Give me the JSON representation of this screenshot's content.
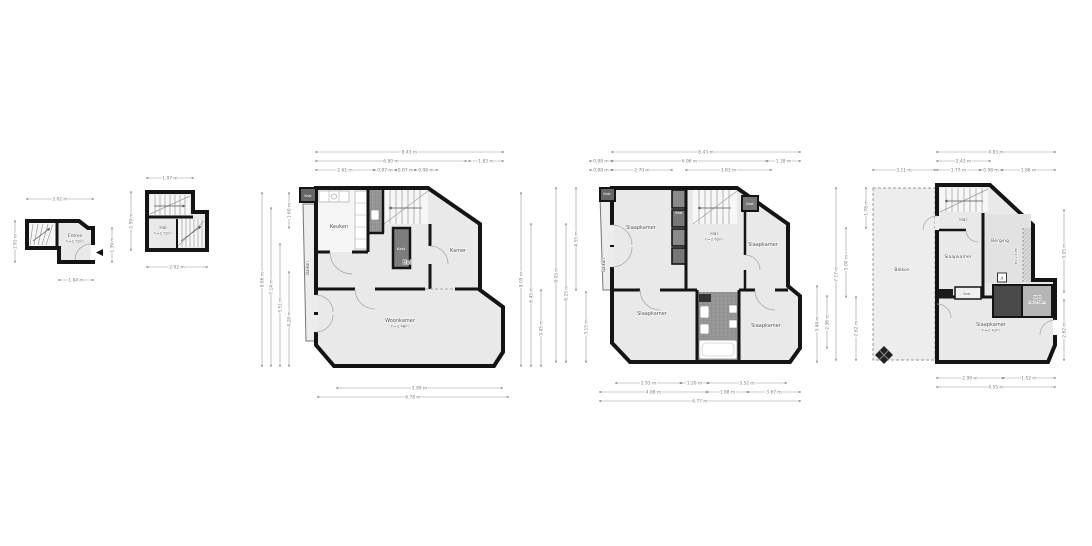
{
  "colors": {
    "wall": "#141414",
    "room": "#e9e9e9",
    "room_light": "#f6f6f6",
    "tiled": "#989898",
    "closet_dark": "#4a4a4a",
    "closet_mid": "#7d7d7d",
    "closet_gray": "#b5b5b5",
    "balcony": "#ededed",
    "dim_line": "#999999",
    "dim_text": "#808080",
    "label_text": "#4a4a4a"
  },
  "plans": [
    {
      "rooms": [
        {
          "label": "Entree",
          "sub": "h=2.52m",
          "x": 75,
          "y": 237,
          "size": 4.4
        }
      ],
      "dims": {
        "horizontal": [
          {
            "label": "3.02 m",
            "x1": 27,
            "x2": 93,
            "y": 199
          },
          {
            "label": "1.84 m",
            "x1": 59,
            "x2": 93,
            "y": 280
          }
        ],
        "vertical": [
          {
            "label": "1.91 m",
            "x": 15,
            "y1": 221,
            "y2": 262
          },
          {
            "label": "1.39 m",
            "x": 112,
            "y1": 228,
            "y2": 262
          }
        ]
      }
    },
    {
      "rooms": [
        {
          "label": "Hal",
          "sub": "h=2.52m",
          "x": 163,
          "y": 229,
          "size": 4.4
        }
      ],
      "dims": {
        "horizontal": [
          {
            "label": "1.97 m",
            "x1": 147,
            "x2": 193,
            "y": 178
          },
          {
            "label": "2.92 m",
            "x1": 147,
            "x2": 207,
            "y": 267
          }
        ],
        "vertical": [
          {
            "label": "2.59 m",
            "x": 131,
            "y1": 192,
            "y2": 250
          }
        ]
      }
    },
    {
      "rooms": [
        {
          "label": "Keuken",
          "x": 339,
          "y": 228
        },
        {
          "label": "Hal",
          "x": 407,
          "y": 264
        },
        {
          "label": "Kamer",
          "x": 458,
          "y": 252
        },
        {
          "label": "Woonkamer",
          "sub": "h=2.48m",
          "x": 400,
          "y": 322
        },
        {
          "label": "Kast",
          "x": 401,
          "y": 250,
          "size": 3.8,
          "color": "#ffffff"
        },
        {
          "label": "Kast",
          "x": 308,
          "y": 197,
          "size": 3.4,
          "color": "#ffffff"
        },
        {
          "label": "Balkon",
          "x": 309,
          "y": 268,
          "size": 4,
          "rot": -90
        }
      ],
      "dims": {
        "horizontal": [
          {
            "label": "8.43 m",
            "x1": 316,
            "x2": 503,
            "y": 152
          },
          {
            "label": "6.80 m",
            "x1": 316,
            "x2": 466,
            "y": 161
          },
          {
            "label": "1.83 m",
            "x1": 469,
            "x2": 503,
            "y": 161
          },
          {
            "label": "2.61 m",
            "x1": 316,
            "x2": 374,
            "y": 170
          },
          {
            "label": "0.97 m",
            "x1": 374,
            "x2": 396,
            "y": 170
          },
          {
            "label": "0.87 m",
            "x1": 396,
            "x2": 415,
            "y": 170
          },
          {
            "label": "0.98 m",
            "x1": 415,
            "x2": 437,
            "y": 170
          },
          {
            "label": "5.99 m",
            "x1": 337,
            "x2": 502,
            "y": 388
          },
          {
            "label": "6.78 m",
            "x1": 318,
            "x2": 508,
            "y": 397
          }
        ],
        "vertical": [
          {
            "label": "8.66 m",
            "x": 262,
            "y1": 193,
            "y2": 366
          },
          {
            "label": "7.14 m",
            "x": 271,
            "y1": 208,
            "y2": 366
          },
          {
            "label": "5.51 m",
            "x": 280,
            "y1": 244,
            "y2": 366
          },
          {
            "label": "4.28 m",
            "x": 289,
            "y1": 272,
            "y2": 366
          },
          {
            "label": "1.60 m",
            "x": 289,
            "y1": 193,
            "y2": 228
          },
          {
            "label": "8.05 m",
            "x": 521,
            "y1": 193,
            "y2": 366
          },
          {
            "label": "6.45 m",
            "x": 531,
            "y1": 224,
            "y2": 366
          },
          {
            "label": "3.45 m",
            "x": 541,
            "y1": 290,
            "y2": 366
          }
        ]
      }
    },
    {
      "rooms": [
        {
          "label": "Slaapkamer",
          "x": 641,
          "y": 229
        },
        {
          "label": "Hal",
          "sub": "h=2.62m",
          "x": 714,
          "y": 235,
          "size": 4.6
        },
        {
          "label": "Slaapkamer",
          "x": 763,
          "y": 246
        },
        {
          "label": "Slaapkamer",
          "x": 652,
          "y": 315
        },
        {
          "label": "Slaapkamer",
          "x": 766,
          "y": 327
        },
        {
          "label": "Kast",
          "x": 679,
          "y": 214,
          "size": 3.4,
          "color": "#ffffff"
        },
        {
          "label": "Kast",
          "x": 607,
          "y": 195,
          "size": 3.4,
          "color": "#ffffff"
        },
        {
          "label": "Kast",
          "x": 750,
          "y": 205,
          "size": 3.4,
          "color": "#ffffff"
        },
        {
          "label": "Balkon",
          "x": 605,
          "y": 265,
          "size": 4,
          "rot": -90
        }
      ],
      "dims": {
        "horizontal": [
          {
            "label": "8.43 m",
            "x1": 612,
            "x2": 800,
            "y": 152
          },
          {
            "label": "0.98 m",
            "x1": 590,
            "x2": 612,
            "y": 161
          },
          {
            "label": "6.96 m",
            "x1": 612,
            "x2": 767,
            "y": 161
          },
          {
            "label": "1.38 m",
            "x1": 767,
            "x2": 800,
            "y": 161
          },
          {
            "label": "0.98 m",
            "x1": 590,
            "x2": 612,
            "y": 170
          },
          {
            "label": "2.70 m",
            "x1": 612,
            "x2": 672,
            "y": 170
          },
          {
            "label": "3.83 m",
            "x1": 686,
            "x2": 771,
            "y": 170
          },
          {
            "label": "2.93 m",
            "x1": 616,
            "x2": 681,
            "y": 383
          },
          {
            "label": "1.20 m",
            "x1": 681,
            "x2": 708,
            "y": 383
          },
          {
            "label": "3.52 m",
            "x1": 708,
            "x2": 786,
            "y": 383
          },
          {
            "label": "4.88 m",
            "x1": 600,
            "x2": 707,
            "y": 392
          },
          {
            "label": "1.88 m",
            "x1": 707,
            "x2": 748,
            "y": 392
          },
          {
            "label": "3.67 m",
            "x1": 748,
            "x2": 800,
            "y": 392
          },
          {
            "label": "6.77 m",
            "x1": 600,
            "x2": 800,
            "y": 401
          }
        ],
        "vertical": [
          {
            "label": "8.05 m",
            "x": 556,
            "y1": 188,
            "y2": 362
          },
          {
            "label": "6.25 m",
            "x": 566,
            "y1": 224,
            "y2": 362
          },
          {
            "label": "4.55 m",
            "x": 576,
            "y1": 188,
            "y2": 290
          },
          {
            "label": "3.15 m",
            "x": 586,
            "y1": 292,
            "y2": 362
          },
          {
            "label": "3.44 m",
            "x": 817,
            "y1": 286,
            "y2": 362
          },
          {
            "label": "2.36 m",
            "x": 827,
            "y1": 296,
            "y2": 348
          }
        ]
      }
    },
    {
      "rooms": [
        {
          "label": "Hal",
          "x": 963,
          "y": 221,
          "size": 4.6
        },
        {
          "label": "Slaapkamer",
          "x": 958,
          "y": 258,
          "size": 4.6
        },
        {
          "label": "Berging",
          "x": 1000,
          "y": 242,
          "size": 4.6
        },
        {
          "label": "h=1.50m",
          "x": 1017,
          "y": 256,
          "size": 3.4,
          "rot": -90
        },
        {
          "label": "Slaapkamer",
          "sub": "h=2.42m",
          "x": 991,
          "y": 326
        },
        {
          "label": "Kast",
          "x": 967,
          "y": 295,
          "size": 3.4
        },
        {
          "label": "Kast",
          "sub": "h=1.50m",
          "x": 1037,
          "y": 298,
          "size": 3.6
        },
        {
          "label": "Balkon",
          "x": 902,
          "y": 271,
          "size": 4.5
        },
        {
          "label": "A",
          "x": 1002,
          "y": 280,
          "size": 4,
          "boxed": true
        }
      ],
      "dims": {
        "horizontal": [
          {
            "label": "4.83 m",
            "x1": 937,
            "x2": 1055,
            "y": 152
          },
          {
            "label": "2.43 m",
            "x1": 937,
            "x2": 990,
            "y": 161
          },
          {
            "label": "3.11 m",
            "x1": 873,
            "x2": 935,
            "y": 170
          },
          {
            "label": "1.77 m",
            "x1": 937,
            "x2": 980,
            "y": 170
          },
          {
            "label": "0.98 m",
            "x1": 980,
            "x2": 1002,
            "y": 170
          },
          {
            "label": "1.86 m",
            "x1": 1002,
            "x2": 1055,
            "y": 170
          },
          {
            "label": "2.99 m",
            "x1": 937,
            "x2": 1003,
            "y": 378
          },
          {
            "label": "1.52 m",
            "x1": 1003,
            "x2": 1055,
            "y": 378
          },
          {
            "label": "4.55 m",
            "x1": 937,
            "x2": 1055,
            "y": 387
          }
        ],
        "vertical": [
          {
            "label": "7.17 m",
            "x": 836,
            "y1": 188,
            "y2": 360
          },
          {
            "label": "3.00 m",
            "x": 846,
            "y1": 228,
            "y2": 297
          },
          {
            "label": "2.62 m",
            "x": 856,
            "y1": 297,
            "y2": 360
          },
          {
            "label": "1.78 m",
            "x": 866,
            "y1": 188,
            "y2": 228
          },
          {
            "label": "3.05 m",
            "x": 1064,
            "y1": 210,
            "y2": 292
          },
          {
            "label": "2.62 m",
            "x": 1064,
            "y1": 300,
            "y2": 360
          }
        ]
      }
    }
  ]
}
